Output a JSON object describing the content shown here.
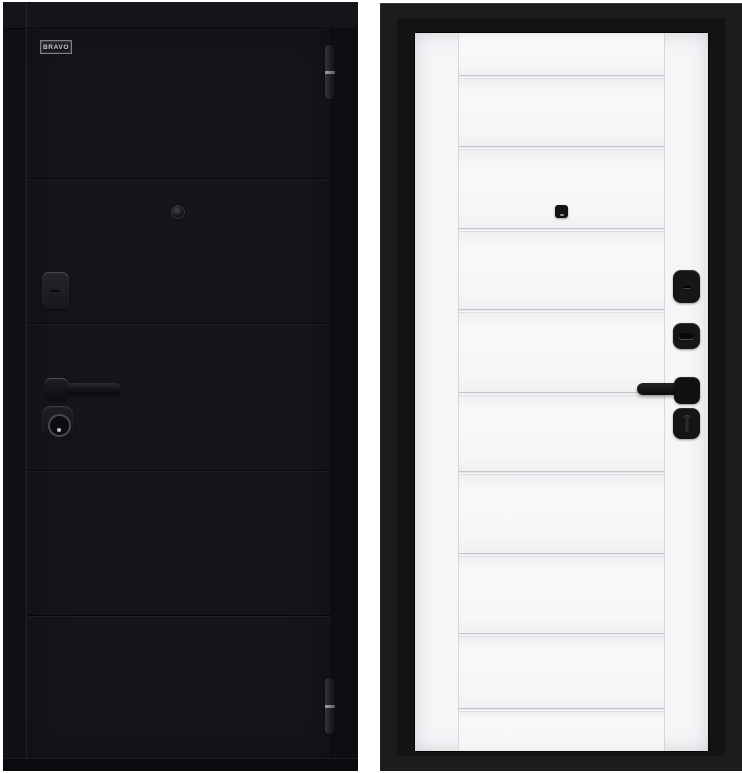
{
  "product": {
    "type": "steel entry door, two-sided product photo",
    "brand": "BRAVO",
    "background_color": "#ffffff"
  },
  "left_door": {
    "side_label": "exterior side",
    "badge_text": "BRAVO",
    "finish_color": "#15161b",
    "panel_count": 6,
    "hardware": [
      "top-hinge",
      "peephole",
      "lock-cover",
      "lever-handle",
      "cylinder-escutcheon",
      "bottom-hinge"
    ]
  },
  "right_door": {
    "side_label": "interior side",
    "leaf_color": "#f5f6f8",
    "frame_color": "#1c1c1f",
    "molding_count": 9,
    "hardware": [
      "peephole",
      "keyhole-cover",
      "cylinder-cover",
      "lever-handle",
      "thumbturn"
    ]
  }
}
